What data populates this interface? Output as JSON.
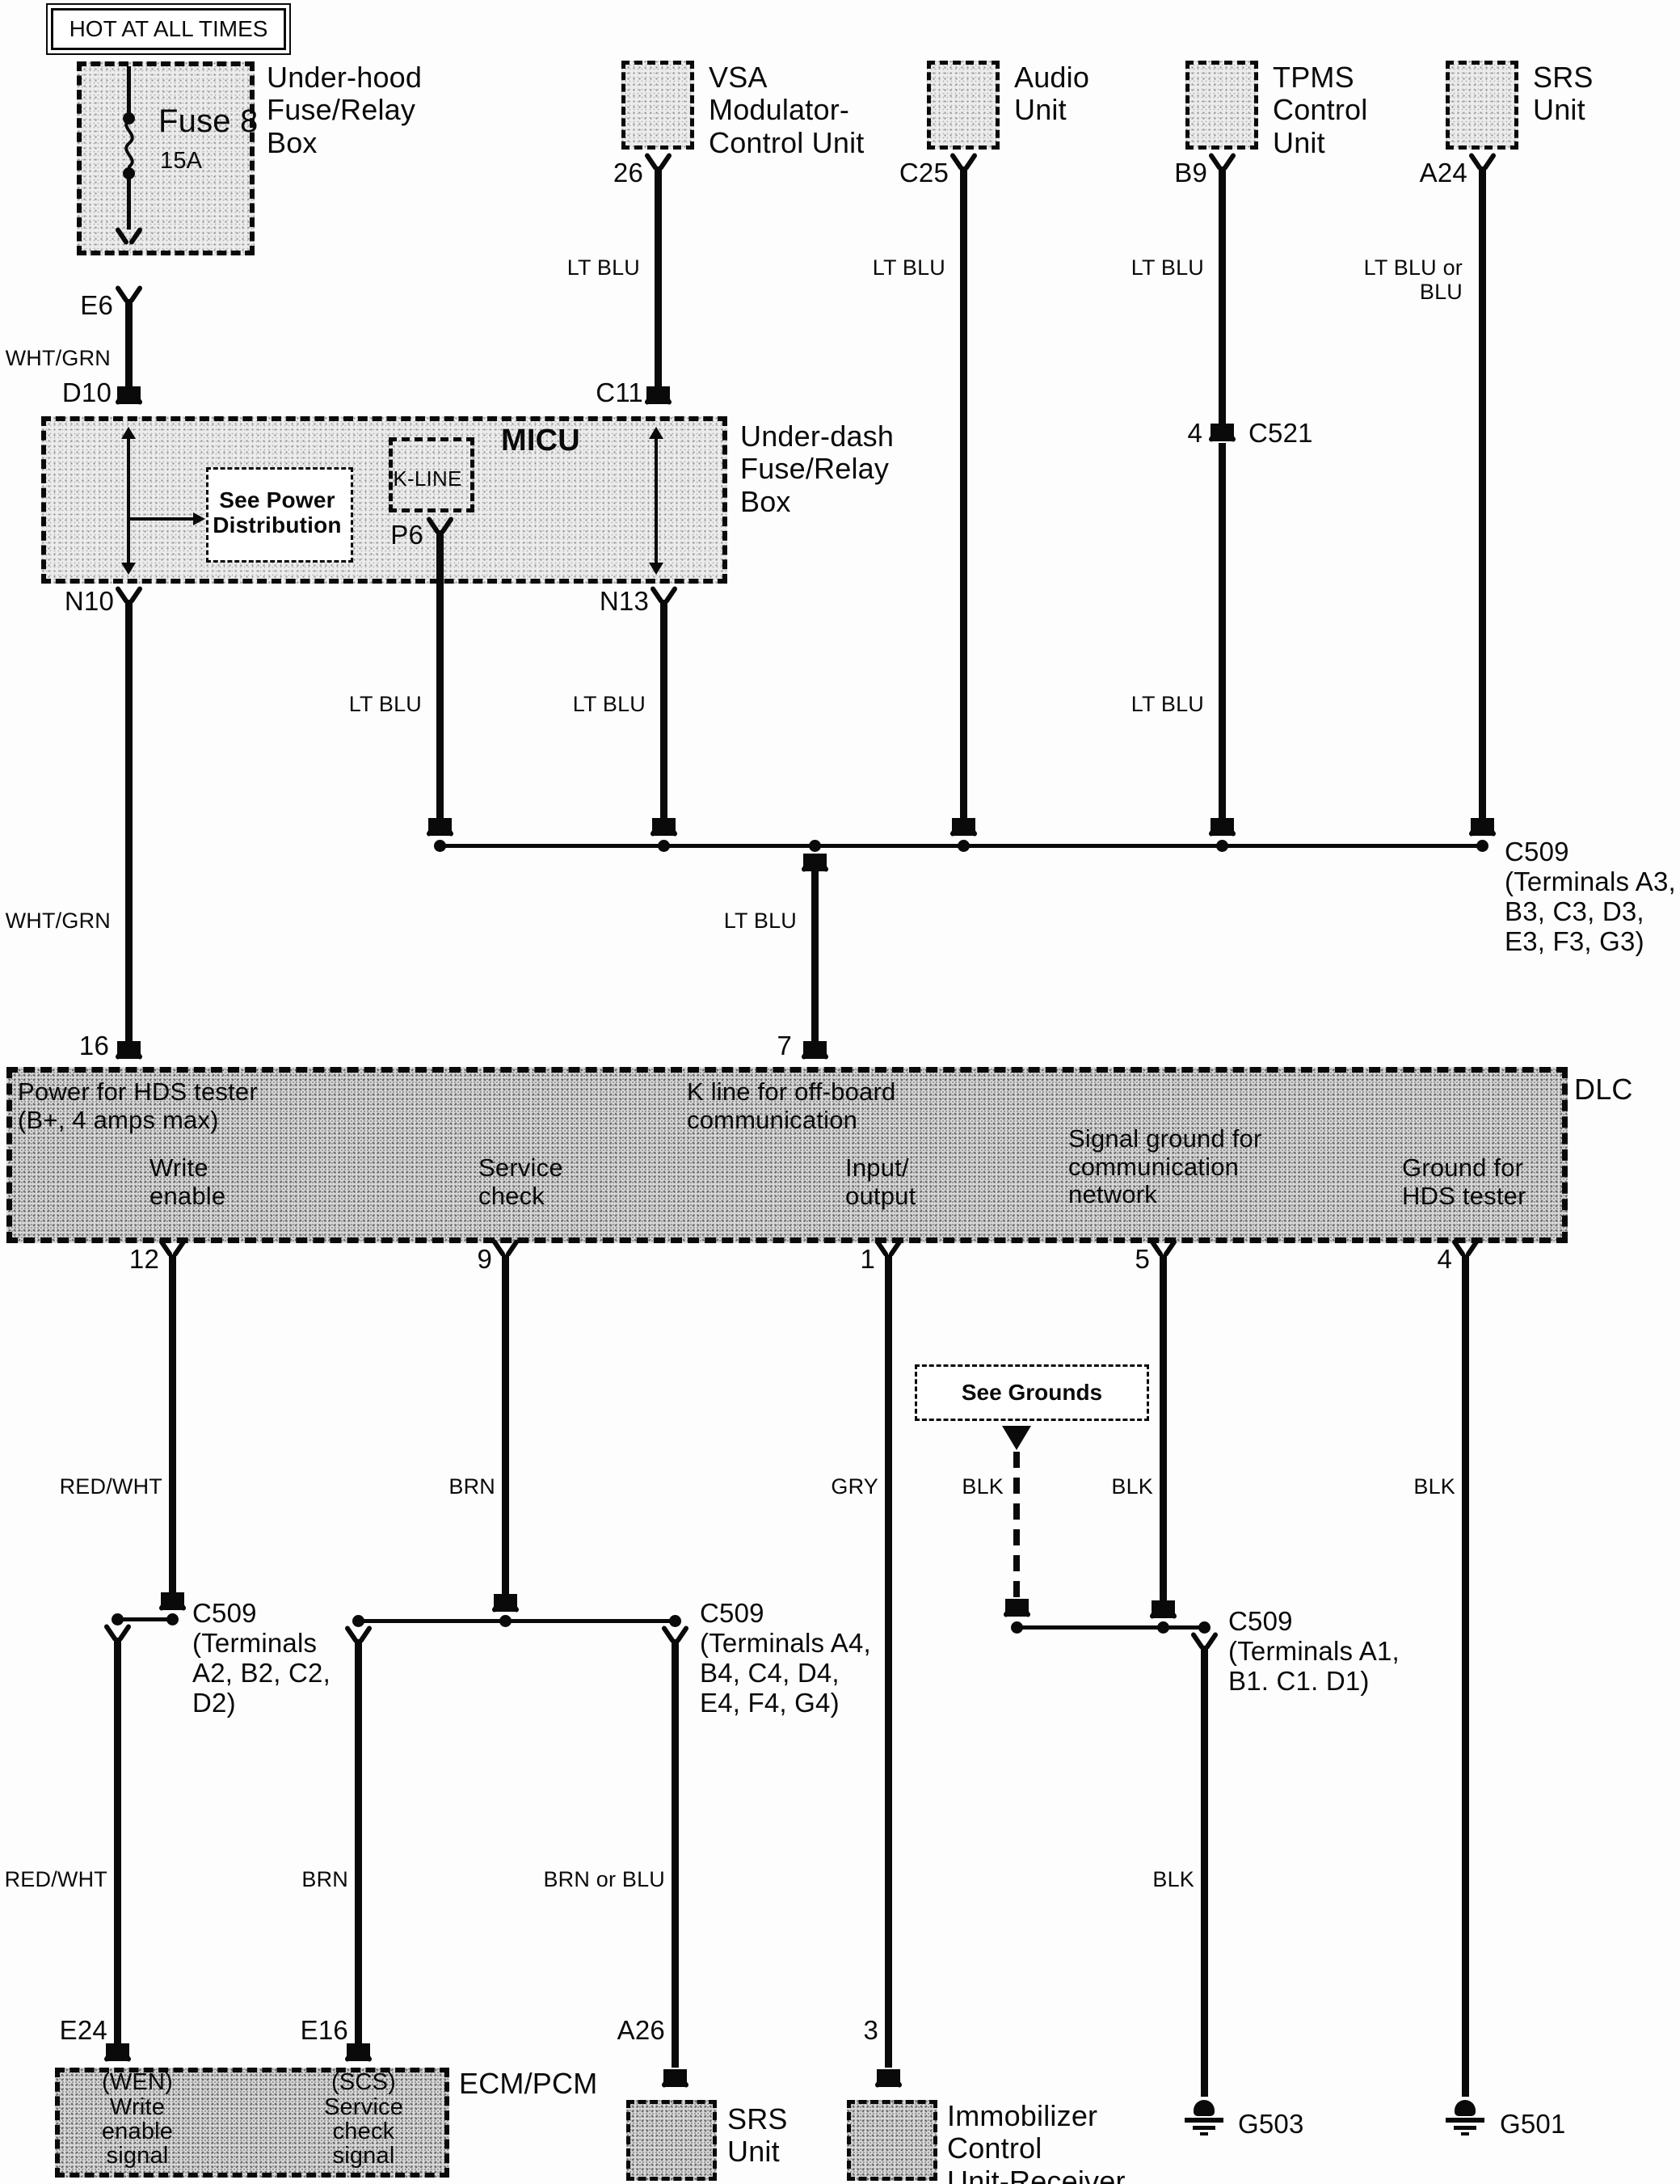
{
  "page": {
    "hot_note": "HOT AT ALL TIMES",
    "dlc_tag": "DLC"
  },
  "underhood": {
    "label": "Under-hood\nFuse/Relay\nBox",
    "fuse": "Fuse 8",
    "amps": "15A",
    "pin_e6": "E6",
    "wire": "WHT/GRN",
    "pin_d10": "D10"
  },
  "vsa": {
    "label": "VSA\nModulator-\nControl Unit",
    "pin": "26",
    "wire": "LT BLU"
  },
  "audio": {
    "label": "Audio\nUnit",
    "pin": "C25",
    "wire": "LT BLU"
  },
  "tpms": {
    "label": "TPMS\nControl\nUnit",
    "pin": "B9",
    "wire": "LT BLU",
    "wire_mid": "LT BLU",
    "c521_pin": "4",
    "c521": "C521"
  },
  "srs_top": {
    "label": "SRS\nUnit",
    "pin": "A24",
    "wire": "LT BLU or\nBLU"
  },
  "underdash": {
    "label": "Under-dash\nFuse/Relay\nBox",
    "micu": "MICU",
    "kline": "K-LINE",
    "see_power": "See Power\nDistribution",
    "pin_c11": "C11",
    "pin_p6": "P6",
    "pin_n10": "N10",
    "pin_n13": "N13",
    "wire_p6": "LT BLU",
    "wire_n13": "LT BLU"
  },
  "trunk": {
    "wire_n10": "WHT/GRN",
    "pin_16": "16",
    "wire_drop": "LT BLU",
    "pin_7": "7",
    "c509": "C509\n(Terminals A3,\nB3, C3, D3,\nE3, F3, G3)"
  },
  "dlc": {
    "power": "Power for HDS tester\n(B+, 4 amps max)",
    "write_enable": "Write\nenable",
    "service_check": "Service\ncheck",
    "k_line": "K line for off-board\ncommunication",
    "input_output": "Input/\noutput",
    "signal_ground": "Signal ground for\ncommunication\nnetwork",
    "ground_hds": "Ground for\nHDS tester",
    "pin_12": "12",
    "pin_9": "9",
    "pin_1": "1",
    "pin_5": "5",
    "pin_4": "4"
  },
  "see_grounds": {
    "label": "See Grounds"
  },
  "wires_upper": {
    "w12": "RED/WHT",
    "w9": "BRN",
    "w1": "GRY",
    "w_sg": "BLK",
    "w5": "BLK",
    "w4": "BLK"
  },
  "c509_left": "C509\n(Terminals\nA2, B2, C2,\nD2)",
  "c509_mid": "C509\n(Terminals A4,\nB4, C4, D4,\nE4, F4, G4)",
  "c509_right": "C509\n(Terminals A1,\nB1. C1. D1)",
  "wires_lower": {
    "e24": "RED/WHT",
    "e16": "BRN",
    "a26": "BRN or BLU",
    "g503": "BLK"
  },
  "ecm": {
    "label": "ECM/PCM",
    "pin_e24": "E24",
    "pin_e16": "E16",
    "wen": "(WEN)\nWrite\nenable\nsignal",
    "scs": "(SCS)\nService\ncheck\nsignal"
  },
  "srs_bottom": {
    "pin": "A26",
    "label": "SRS\nUnit"
  },
  "immobilizer": {
    "pin": "3",
    "label": "Immobilizer\nControl\nUnit-Receiver"
  },
  "grounds": {
    "g503": "G503",
    "g501": "G501"
  }
}
